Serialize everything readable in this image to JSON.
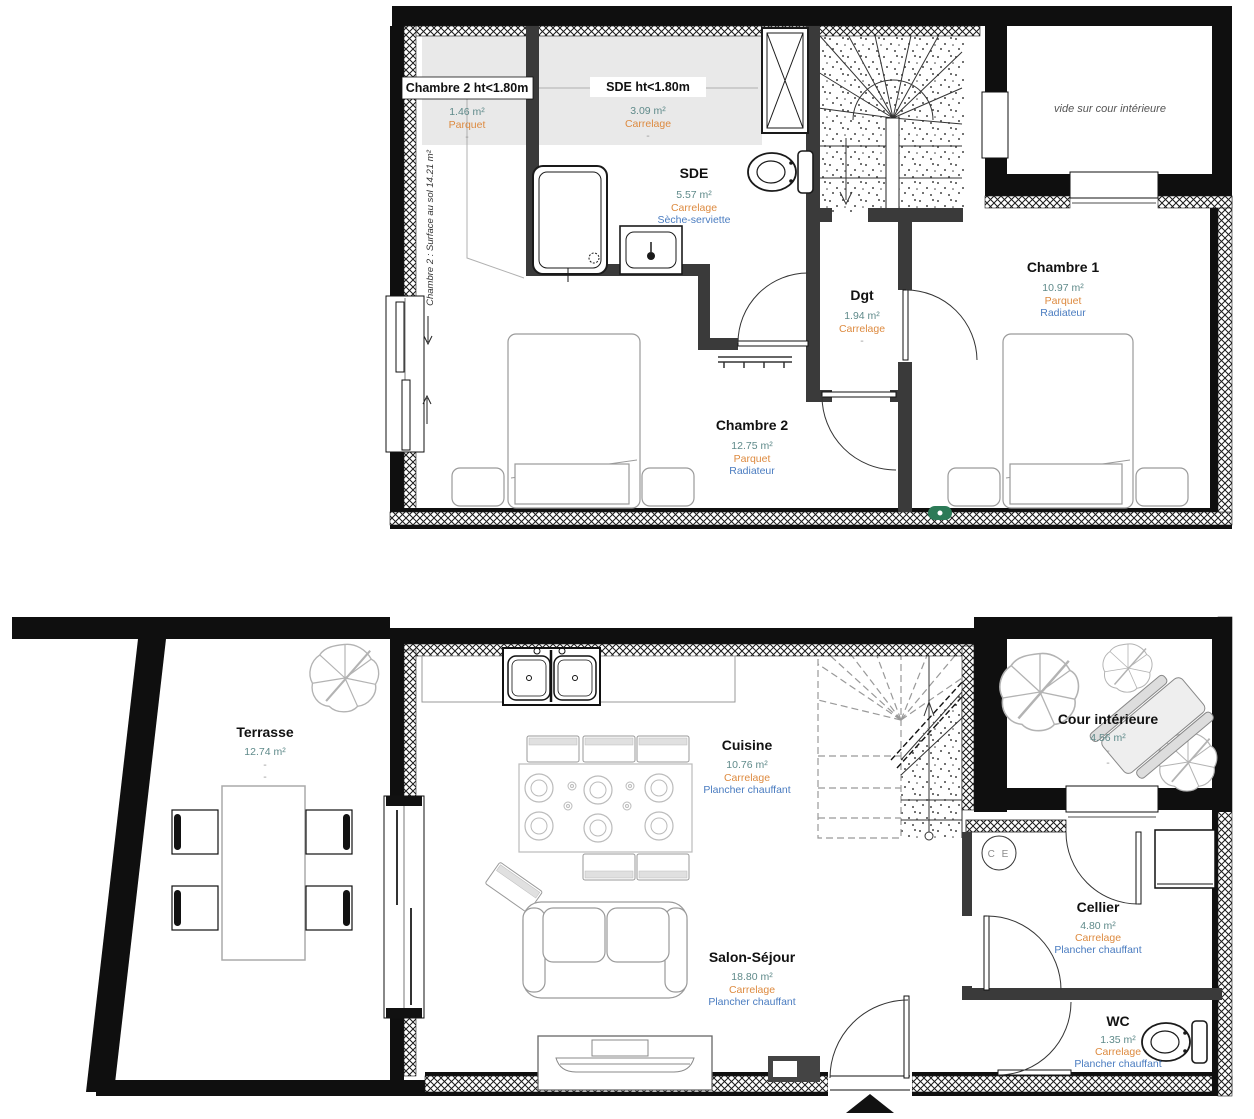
{
  "floors": {
    "upper": {
      "rooms": {
        "chambre2_ht": {
          "name": "Chambre 2 ht<1.80m",
          "area": "1.46 m²",
          "floor": "Parquet",
          "note": "-"
        },
        "sde_ht": {
          "name": "SDE ht<1.80m",
          "area": "3.09 m²",
          "floor": "Carrelage",
          "note": "-"
        },
        "sde": {
          "name": "SDE",
          "area": "5.57 m²",
          "floor": "Carrelage",
          "note": "Sèche-serviette"
        },
        "dgt": {
          "name": "Dgt",
          "area": "1.94 m²",
          "floor": "Carrelage",
          "note": "-"
        },
        "chambre1": {
          "name": "Chambre 1",
          "area": "10.97 m²",
          "floor": "Parquet",
          "note": "Radiateur"
        },
        "chambre2": {
          "name": "Chambre 2",
          "area": "12.75 m²",
          "floor": "Parquet",
          "note": "Radiateur"
        }
      },
      "annotations": {
        "vide": "vide sur cour intérieure",
        "surface_note": "Chambre 2 : Surface au sol  14.21 m²"
      }
    },
    "ground": {
      "rooms": {
        "terrasse": {
          "name": "Terrasse",
          "area": "12.74 m²",
          "floor": "-",
          "note": "-"
        },
        "cuisine": {
          "name": "Cuisine",
          "area": "10.76 m²",
          "floor": "Carrelage",
          "note": "Plancher chauffant"
        },
        "cour": {
          "name": "Cour intérieure",
          "area": "4.56 m²",
          "floor": "-",
          "note": "-"
        },
        "cellier": {
          "name": "Cellier",
          "area": "4.80 m²",
          "floor": "Carrelage",
          "note": "Plancher chauffant"
        },
        "salon": {
          "name": "Salon-Séjour",
          "area": "18.80 m²",
          "floor": "Carrelage",
          "note": "Plancher chauffant"
        },
        "wc": {
          "name": "WC",
          "area": "1.35 m²",
          "floor": "Carrelage",
          "note": "Plancher chauffant"
        }
      },
      "annotations": {
        "ce": "C E"
      }
    }
  },
  "colors": {
    "area_text": "#5f8a8a",
    "material_text": "#dd8a3f",
    "equipment_text": "#4a7cc0",
    "wall": "#111111",
    "accent_green": "#2c7a57"
  }
}
